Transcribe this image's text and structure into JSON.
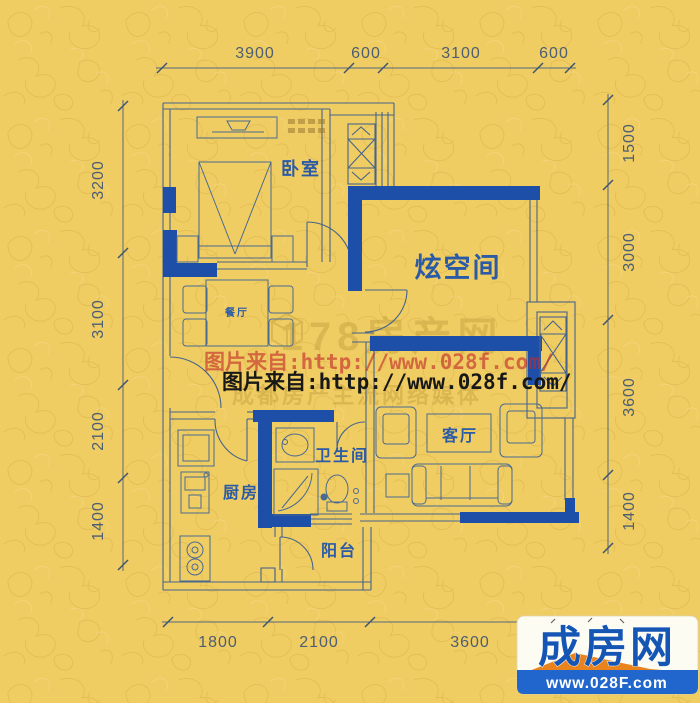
{
  "dimensions": {
    "top": [
      "3900",
      "600",
      "3100",
      "600"
    ],
    "left": [
      "3200",
      "3100",
      "2100",
      "1400"
    ],
    "right": [
      "1500",
      "3000",
      "3600",
      "1400"
    ],
    "bottom": [
      "1800",
      "2100",
      "3600"
    ]
  },
  "rooms": {
    "bedroom": "卧室",
    "flex_space": "炫空间",
    "dining": "餐厅",
    "kitchen": "厨房",
    "bathroom": "卫生间",
    "living_room": "客厅",
    "balcony": "阳台"
  },
  "watermarks": {
    "source_line_red": "图片来自:http://www.028f.com/",
    "source_line_black": "图片来自:http://www.028f.com/",
    "site_name": "178房产网",
    "site_slogan": "成都房产主流网络媒体"
  },
  "logo": {
    "brand": "成房网",
    "website": "www.028F.com"
  },
  "colors": {
    "background": "#f0cd62",
    "wall_blue": "#1d4fa8",
    "label_blue": "#2b5aa6",
    "watermark_red": "#c22a2a",
    "logo_blue": "#1556b4",
    "logo_bar_blue": "#2166cc",
    "logo_orange": "#e8831d"
  }
}
